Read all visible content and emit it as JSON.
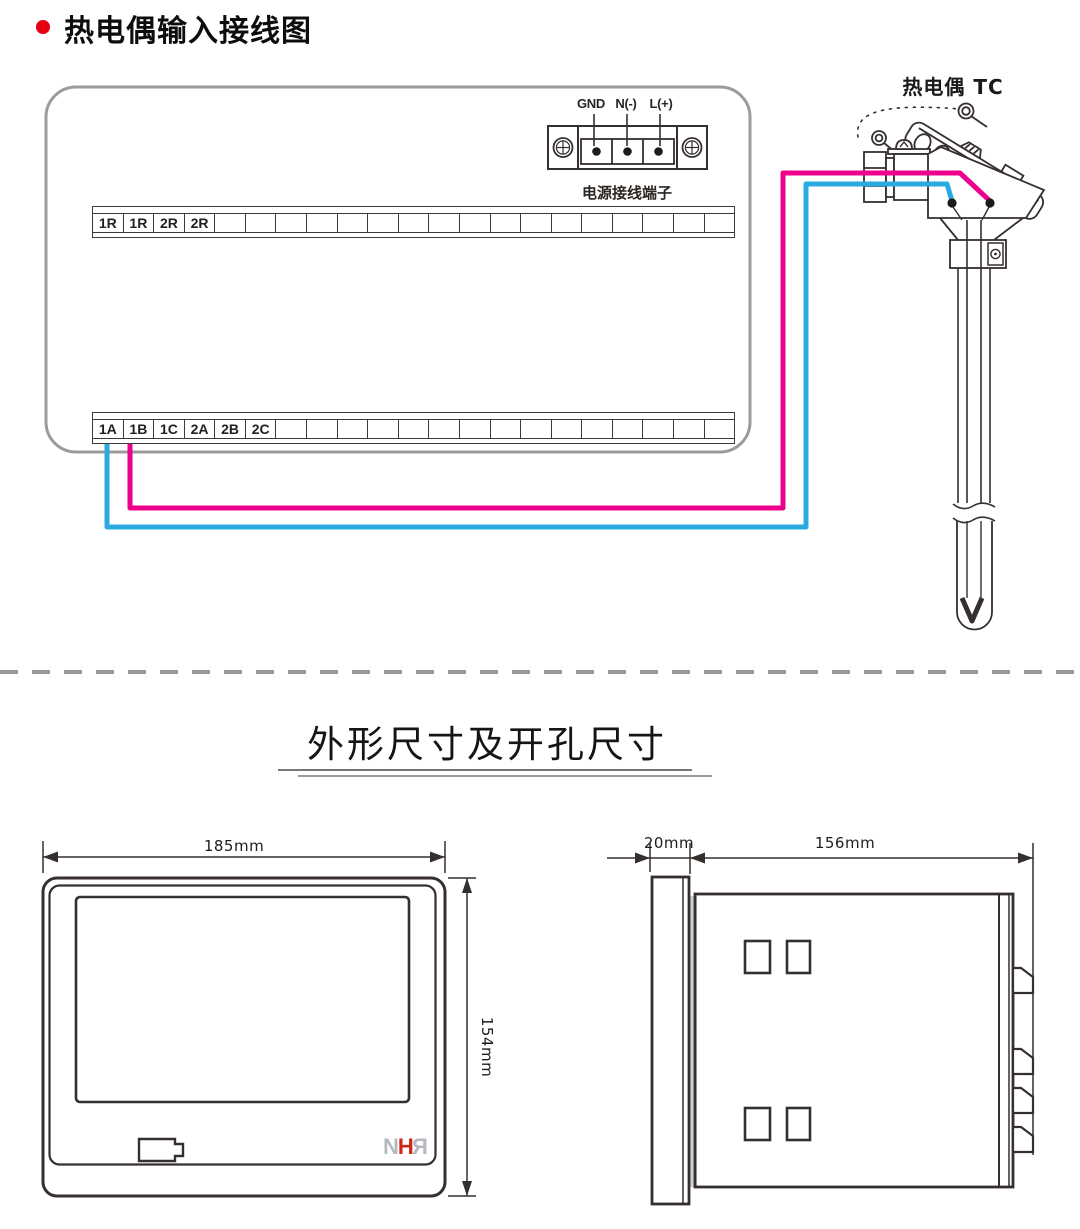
{
  "header": {
    "title": "热电偶输入接线图"
  },
  "wiring": {
    "power_terminal": {
      "label_gnd": "GND",
      "label_n": "N(-)",
      "label_l": "L(+)",
      "caption": "电源接线端子"
    },
    "top_strip": {
      "cells": [
        "1R",
        "1R",
        "2R",
        "2R",
        "",
        "",
        "",
        "",
        "",
        "",
        "",
        "",
        "",
        "",
        "",
        "",
        "",
        "",
        "",
        "",
        ""
      ]
    },
    "bottom_strip": {
      "cells": [
        "1A",
        "1B",
        "1C",
        "2A",
        "2B",
        "2C",
        "",
        "",
        "",
        "",
        "",
        "",
        "",
        "",
        "",
        "",
        "",
        "",
        "",
        "",
        ""
      ]
    },
    "thermocouple_label": "热电偶 TC",
    "wire_colors": {
      "thermocouple_plus": "#ec008c",
      "thermocouple_minus": "#29abe2"
    }
  },
  "dimensions": {
    "section_title": "外形尺寸及开孔尺寸",
    "front_view": {
      "width": "185mm",
      "height": "154mm"
    },
    "side_view": {
      "bezel_depth": "20mm",
      "body_depth": "156mm"
    },
    "logo": {
      "n": "N",
      "h": "H",
      "r": "R"
    }
  }
}
